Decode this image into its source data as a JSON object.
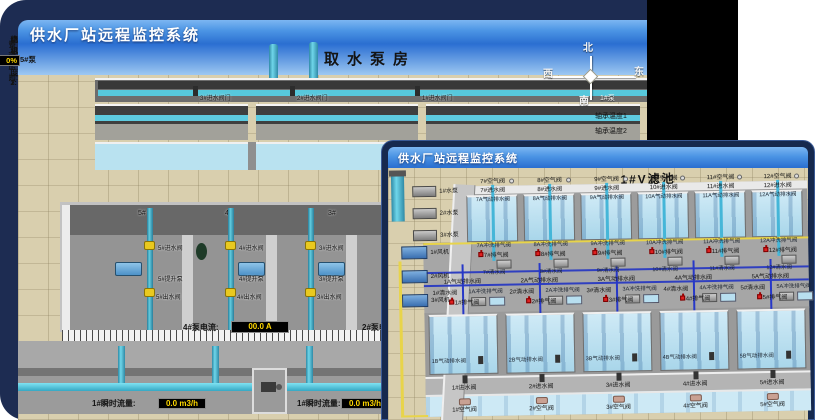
{
  "colors": {
    "panel_navy": "#1d2c52",
    "title_gradient_top": "#7cb6f2",
    "title_gradient_bottom": "#2a6ed0",
    "value_yellow": "#ffd800",
    "alarm_red": "#e02020",
    "pipe_cyan": "#45b6d8",
    "pipe_yellow": "#e8d44a",
    "pipe_blue": "#2f3fc0",
    "water": "#b9e2f0",
    "floor_tan": "#d9cfae"
  },
  "back_window": {
    "title": "供水厂站远程监控系统",
    "scene_title": "取水泵房",
    "pump_panel": {
      "header": "5#泵",
      "rows": [
        {
          "label": "轴承温度1:",
          "value": "100.0℃"
        },
        {
          "label": "轴承温度2:",
          "value": "100.0℃"
        },
        {
          "label": "电机温度1:",
          "value": "18.1℃"
        },
        {
          "label": "电机温度2:",
          "value": "17.9℃"
        },
        {
          "label": "绕组温度1:",
          "value": "18.0℃"
        },
        {
          "label": "绕组温度2:",
          "value": "18.1℃"
        },
        {
          "label": "绕组温度3:",
          "value": "18.1℃"
        },
        {
          "label": "管道压力:",
          "value": "0.0007MPa"
        },
        {
          "label": "多功能阀:",
          "value": "0%"
        }
      ]
    },
    "inlet_valve_labels": [
      "3#进水阀门",
      "2#进水阀门",
      "1#进水阀门"
    ],
    "compass": {
      "north": "北",
      "west": "西",
      "south": "南",
      "east": "东"
    },
    "partial_labels": {
      "pump1": "1#泵",
      "bearing1": "轴承温度1",
      "bearing2": "轴承温度2"
    },
    "bays": [
      {
        "wall": "5#",
        "inlet": "5#进水阀",
        "pump": "5#提升泵",
        "outlet": "5#出水阀"
      },
      {
        "wall": "4#",
        "inlet": "4#进水阀",
        "pump": "4#提升泵",
        "outlet": "4#出水阀"
      },
      {
        "wall": "3#",
        "inlet": "3#进水阀",
        "pump": "3#提升泵",
        "outlet": "3#出水阀"
      },
      {
        "wall": "2#",
        "inlet": "2#进水阀",
        "pump": "2#提升泵",
        "outlet": "2#出水阀"
      }
    ],
    "readouts": {
      "pump4_current": {
        "label": "4#泵电流:",
        "value": "00.0 A"
      },
      "pump2_current": {
        "label": "2#泵电流:",
        "value": ""
      },
      "flow_left": {
        "label": "1#瞬时流量:",
        "value": "0.0 m3/h"
      },
      "flow_right": {
        "label": "1#瞬时流量:",
        "value": "0.0 m3/h"
      }
    }
  },
  "front_window": {
    "title": "供水厂站远程监控系统",
    "scene_title": "1#V滤池",
    "left_equipment": {
      "pumps": [
        "1#水泵",
        "2#水泵",
        "3#水泵"
      ],
      "blowers": [
        "1#风机",
        "2#风机",
        "3#风机"
      ]
    },
    "upper_cells": {
      "air": [
        "7#空气阀",
        "8#空气阀",
        "9#空气阀",
        "10#空气阀",
        "11#空气阀",
        "12#空气阀"
      ],
      "inlet": [
        "7#进水阀",
        "8#进水阀",
        "9#进水阀",
        "10#进水阀",
        "11#进水阀",
        "12#进水阀"
      ],
      "drain": [
        "7A气动排水阀",
        "8A气动排水阀",
        "9A气动排水阀",
        "10A气动排水阀",
        "11A气动排水阀",
        "12A气动排水阀"
      ]
    },
    "gallery": {
      "flush_vent_upper": [
        "7A冲洗排气阀",
        "8A冲洗排气阀",
        "9A冲洗排气阀",
        "10A冲洗排气阀",
        "11A冲洗排气阀",
        "12A冲洗排气阀"
      ],
      "vent_upper": [
        "7#排气阀",
        "8#排气阀",
        "9#排气阀",
        "10#排气阀",
        "11#排气阀",
        "12#排气阀"
      ],
      "clear_upper": [
        "7#清水阀",
        "8#清水阀",
        "9#清水阀",
        "10#清水阀",
        "11#清水阀",
        "12#清水阀"
      ],
      "drain_lower": [
        "1A气动排水阀",
        "2A气动排水阀",
        "3A气动排水阀",
        "4A气动排水阀",
        "5A气动排水阀",
        "6A气动排水阀"
      ],
      "clear_lower": [
        "1#清水阀",
        "2#清水阀",
        "3#清水阀",
        "4#清水阀",
        "5#清水阀",
        "6#清水阀"
      ],
      "flush_vent_lower": [
        "1A冲洗排气阀",
        "2A冲洗排气阀",
        "3A冲洗排气阀",
        "4A冲洗排气阀",
        "5A冲洗排气阀",
        "6A冲洗排气阀"
      ],
      "vent_lower": [
        "1#排气阀",
        "2#排气阀",
        "3#排气阀",
        "4#排气阀",
        "5#排气阀",
        "6#排气阀"
      ]
    },
    "lower_cells": {
      "drain": [
        "1B气动排水阀",
        "2B气动排水阀",
        "3B气动排水阀",
        "4B气动排水阀",
        "5B气动排水阀",
        "6B气动排水阀"
      ],
      "inlet": [
        "1#进水阀",
        "2#进水阀",
        "3#进水阀",
        "4#进水阀",
        "5#进水阀",
        "6#进水阀"
      ],
      "air": [
        "1#空气阀",
        "2#空气阀",
        "3#空气阀",
        "4#空气阀",
        "5#空气阀",
        "6#空气阀"
      ]
    }
  }
}
